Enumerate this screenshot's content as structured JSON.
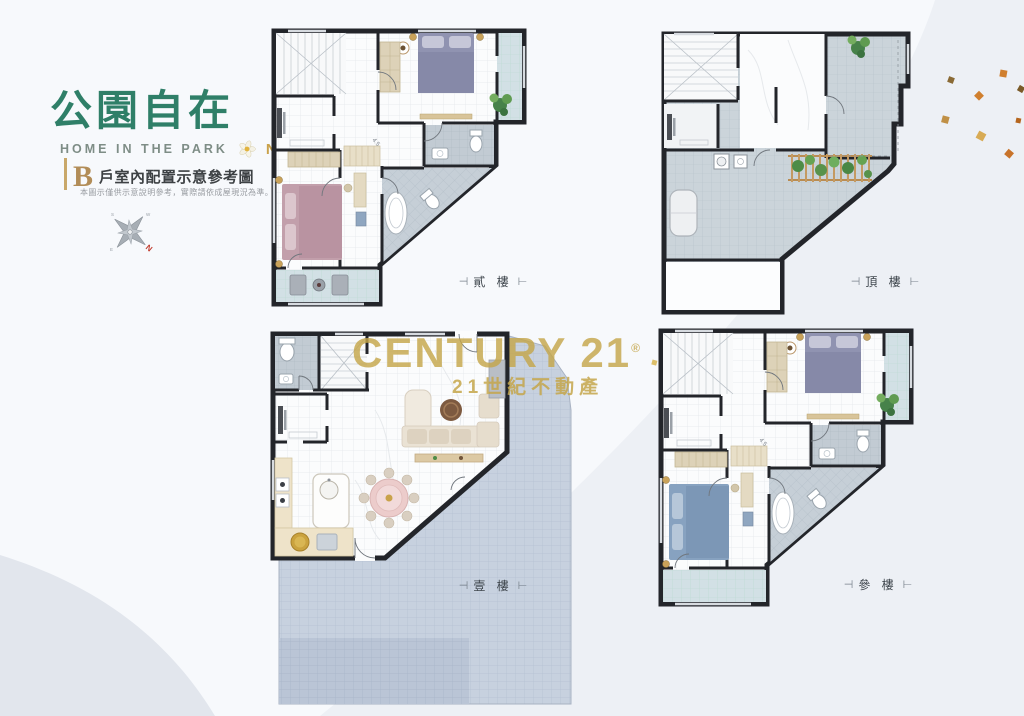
{
  "brand": {
    "title": "公園自在",
    "subtitle": "HOME IN THE PARK",
    "number": "NO.5"
  },
  "section": {
    "unit": "B",
    "heading": "戶室內配置示意參考圖",
    "disclaimer": "本圖示僅供示意說明參考，實際請依成屋現況為準。"
  },
  "compass": {
    "north": "N",
    "east": "E",
    "south": "S",
    "west": "W"
  },
  "watermark": {
    "brand_text": "CENTURY 21",
    "reg": "®",
    "sub_text": "21世紀不動產"
  },
  "floors": {
    "second": {
      "label": "貳 樓",
      "area_note": "4.5"
    },
    "roof": {
      "label": "頂 樓"
    },
    "first": {
      "label": "壹 樓"
    },
    "third": {
      "label": "參 樓",
      "area_note": "4.5"
    }
  },
  "label_decor": {
    "left": "⊣",
    "right": "⊢"
  },
  "colors": {
    "brand_green": "#2f7f68",
    "gold": "#c9a24b",
    "watermark_gold": "#c4a64a",
    "wall": "#23252a"
  }
}
